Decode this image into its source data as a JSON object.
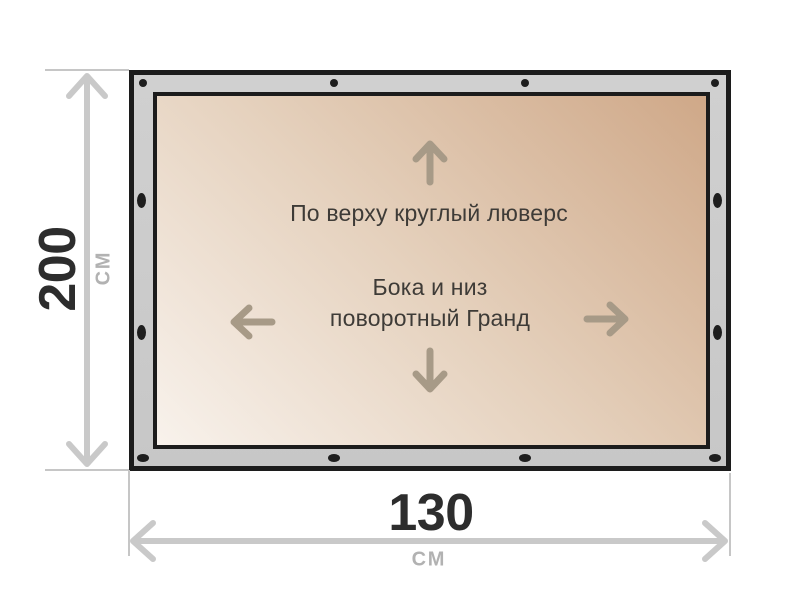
{
  "diagram": {
    "type": "product-dimension-diagram",
    "panel_labels": {
      "top_edge": "По верху круглый люверс",
      "sides_line1": "Бока и низ",
      "sides_line2": "поворотный Гранд"
    },
    "dimensions": {
      "height_value": "200",
      "height_unit": "СМ",
      "width_value": "130",
      "width_unit": "СМ"
    },
    "grommets": {
      "top_count": 4,
      "bottom_count": 4,
      "left_count": 2,
      "right_count": 2
    },
    "colors": {
      "frame_fill": "#cacaca",
      "frame_border": "#1c1c1c",
      "grommet": "#1e1e1e",
      "panel_gradient_light": "#f8f2ec",
      "panel_gradient_dark": "#cfa888",
      "inner_arrow": "#a79a87",
      "inner_text": "#3e3b37",
      "dimension_arrow": "#c9c9c9",
      "dimension_value_text": "#2d2d2d",
      "dimension_unit_text": "#b2b2b2"
    }
  }
}
